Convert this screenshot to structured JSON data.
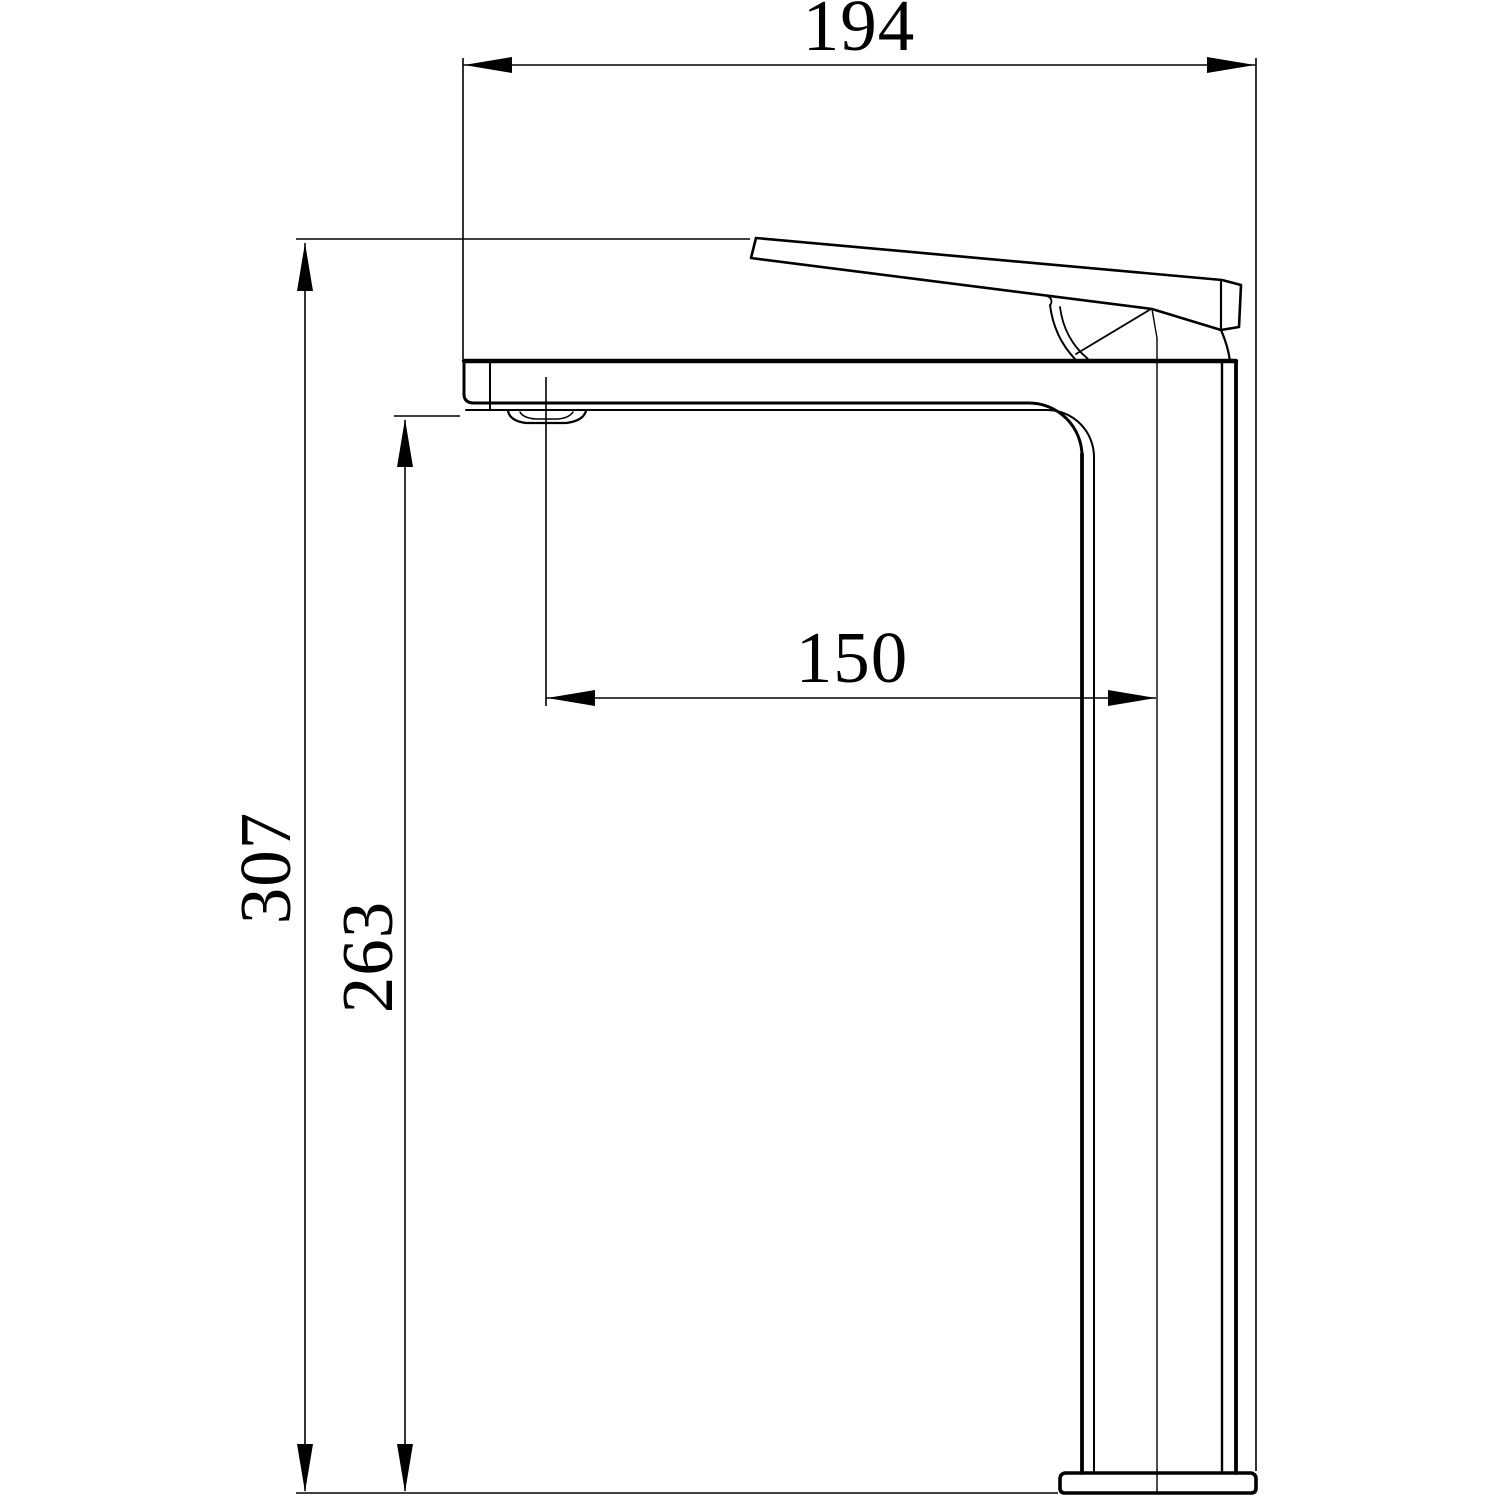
{
  "drawing": {
    "colors": {
      "ink": "#000000",
      "background": "#ffffff"
    },
    "dimensions": {
      "overall_width": "194",
      "overall_height": "307",
      "outlet_height": "263",
      "spout_reach": "150"
    }
  }
}
